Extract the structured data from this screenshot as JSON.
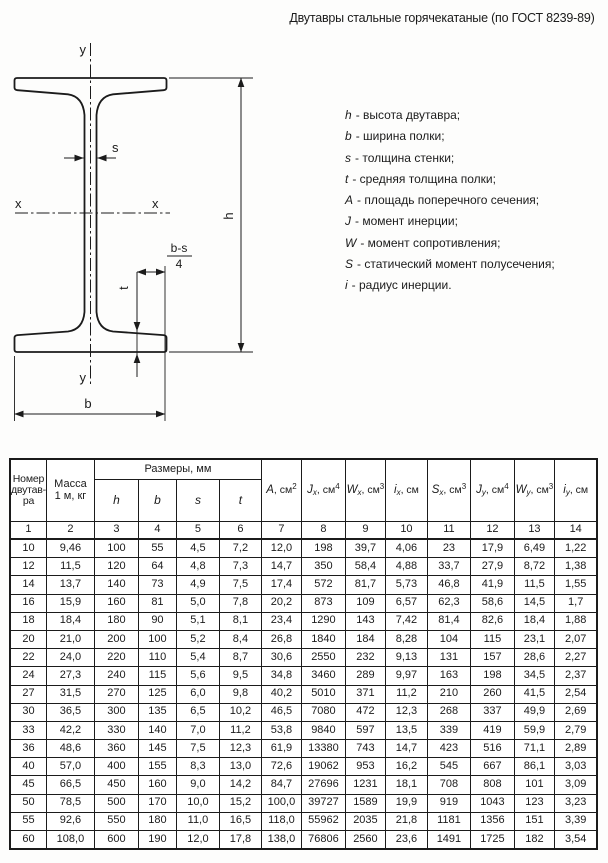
{
  "title": "Двутавры стальные горячекатаные (по ГОСТ 8239-89)",
  "drawing": {
    "labels": {
      "y_top": "y",
      "y_bottom": "y",
      "x_left": "x",
      "x_right": "x",
      "s": "s",
      "h": "h",
      "b": "b",
      "t": "t",
      "bs_numerator": "b-s",
      "bs_denominator": "4"
    }
  },
  "legend": {
    "items": [
      {
        "sym": "h",
        "text": "- высота двутавра;"
      },
      {
        "sym": "b",
        "text": "- ширина полки;"
      },
      {
        "sym": "s",
        "text": "- толщина стенки;"
      },
      {
        "sym": "t",
        "text": "- средняя толщина полки;"
      },
      {
        "sym": "A",
        "text": "- площадь поперечного сечения;"
      },
      {
        "sym": "J",
        "text": "- момент инерции;"
      },
      {
        "sym": "W",
        "text": "- момент сопротивления;"
      },
      {
        "sym": "S",
        "text": "- статический момент  полусечения;"
      },
      {
        "sym": "i",
        "text": "- радиус инерции."
      }
    ]
  },
  "table": {
    "col1": "Номер\nдвутав-\nра",
    "col2": "Масса\n1 м, кг",
    "group_header": "Размеры, мм",
    "dims": [
      "h",
      "b",
      "s",
      "t"
    ],
    "value_cols": [
      {
        "sym": "A",
        "sub": "",
        "unit": ", см",
        "sup": "2"
      },
      {
        "sym": "J",
        "sub": "x",
        "unit": ", см",
        "sup": "4"
      },
      {
        "sym": "W",
        "sub": "x",
        "unit": ", см",
        "sup": "3"
      },
      {
        "sym": "i",
        "sub": "x",
        "unit": ", см",
        "sup": ""
      },
      {
        "sym": "S",
        "sub": "x",
        "unit": ", см",
        "sup": "3"
      },
      {
        "sym": "J",
        "sub": "y",
        "unit": ", см",
        "sup": "4"
      },
      {
        "sym": "W",
        "sub": "y",
        "unit": ", см",
        "sup": "3"
      },
      {
        "sym": "i",
        "sub": "y",
        "unit": ", см",
        "sup": ""
      }
    ],
    "numbers": [
      "1",
      "2",
      "3",
      "4",
      "5",
      "6",
      "7",
      "8",
      "9",
      "10",
      "11",
      "12",
      "13",
      "14"
    ],
    "rows": [
      [
        "10",
        "9,46",
        "100",
        "55",
        "4,5",
        "7,2",
        "12,0",
        "198",
        "39,7",
        "4,06",
        "23",
        "17,9",
        "6,49",
        "1,22"
      ],
      [
        "12",
        "11,5",
        "120",
        "64",
        "4,8",
        "7,3",
        "14,7",
        "350",
        "58,4",
        "4,88",
        "33,7",
        "27,9",
        "8,72",
        "1,38"
      ],
      [
        "14",
        "13,7",
        "140",
        "73",
        "4,9",
        "7,5",
        "17,4",
        "572",
        "81,7",
        "5,73",
        "46,8",
        "41,9",
        "11,5",
        "1,55"
      ],
      [
        "16",
        "15,9",
        "160",
        "81",
        "5,0",
        "7,8",
        "20,2",
        "873",
        "109",
        "6,57",
        "62,3",
        "58,6",
        "14,5",
        "1,7"
      ],
      [
        "18",
        "18,4",
        "180",
        "90",
        "5,1",
        "8,1",
        "23,4",
        "1290",
        "143",
        "7,42",
        "81,4",
        "82,6",
        "18,4",
        "1,88"
      ],
      [
        "20",
        "21,0",
        "200",
        "100",
        "5,2",
        "8,4",
        "26,8",
        "1840",
        "184",
        "8,28",
        "104",
        "115",
        "23,1",
        "2,07"
      ],
      [
        "22",
        "24,0",
        "220",
        "110",
        "5,4",
        "8,7",
        "30,6",
        "2550",
        "232",
        "9,13",
        "131",
        "157",
        "28,6",
        "2,27"
      ],
      [
        "24",
        "27,3",
        "240",
        "115",
        "5,6",
        "9,5",
        "34,8",
        "3460",
        "289",
        "9,97",
        "163",
        "198",
        "34,5",
        "2,37"
      ],
      [
        "27",
        "31,5",
        "270",
        "125",
        "6,0",
        "9,8",
        "40,2",
        "5010",
        "371",
        "11,2",
        "210",
        "260",
        "41,5",
        "2,54"
      ],
      [
        "30",
        "36,5",
        "300",
        "135",
        "6,5",
        "10,2",
        "46,5",
        "7080",
        "472",
        "12,3",
        "268",
        "337",
        "49,9",
        "2,69"
      ],
      [
        "33",
        "42,2",
        "330",
        "140",
        "7,0",
        "11,2",
        "53,8",
        "9840",
        "597",
        "13,5",
        "339",
        "419",
        "59,9",
        "2,79"
      ],
      [
        "36",
        "48,6",
        "360",
        "145",
        "7,5",
        "12,3",
        "61,9",
        "13380",
        "743",
        "14,7",
        "423",
        "516",
        "71,1",
        "2,89"
      ],
      [
        "40",
        "57,0",
        "400",
        "155",
        "8,3",
        "13,0",
        "72,6",
        "19062",
        "953",
        "16,2",
        "545",
        "667",
        "86,1",
        "3,03"
      ],
      [
        "45",
        "66,5",
        "450",
        "160",
        "9,0",
        "14,2",
        "84,7",
        "27696",
        "1231",
        "18,1",
        "708",
        "808",
        "101",
        "3,09"
      ],
      [
        "50",
        "78,5",
        "500",
        "170",
        "10,0",
        "15,2",
        "100,0",
        "39727",
        "1589",
        "19,9",
        "919",
        "1043",
        "123",
        "3,23"
      ],
      [
        "55",
        "92,6",
        "550",
        "180",
        "11,0",
        "16,5",
        "118,0",
        "55962",
        "2035",
        "21,8",
        "1181",
        "1356",
        "151",
        "3,39"
      ],
      [
        "60",
        "108,0",
        "600",
        "190",
        "12,0",
        "17,8",
        "138,0",
        "76806",
        "2560",
        "23,6",
        "1491",
        "1725",
        "182",
        "3,54"
      ]
    ]
  },
  "colors": {
    "ink": "#1b1b1b",
    "paper": "#fdfdfc"
  }
}
